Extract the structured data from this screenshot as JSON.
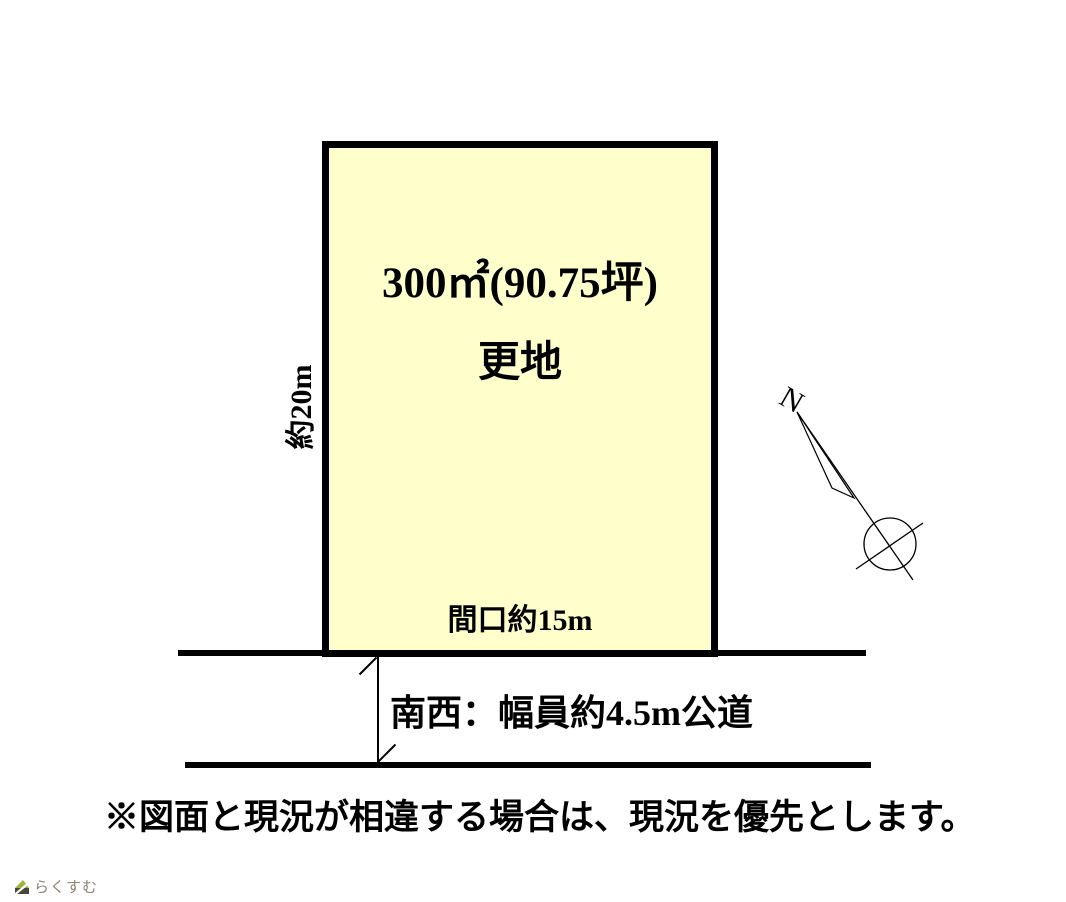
{
  "diagram": {
    "plot": {
      "area_label": "300㎡(90.75坪)",
      "condition_label": "更地",
      "frontage_label": "間口約15m",
      "depth_label": "約20m",
      "fill_color": "#ffffcc",
      "border_color": "#000000"
    },
    "road": {
      "label": "南西：幅員約4.5m公道"
    },
    "compass": {
      "north_label": "N"
    },
    "note": "※図面と現況が相違する場合は、現況を優先とします。"
  },
  "footer": {
    "logo_text": "らくすむ",
    "logo_green": "#9cb53c",
    "logo_dark": "#4a463c",
    "logo_text_color": "#8d8274"
  }
}
